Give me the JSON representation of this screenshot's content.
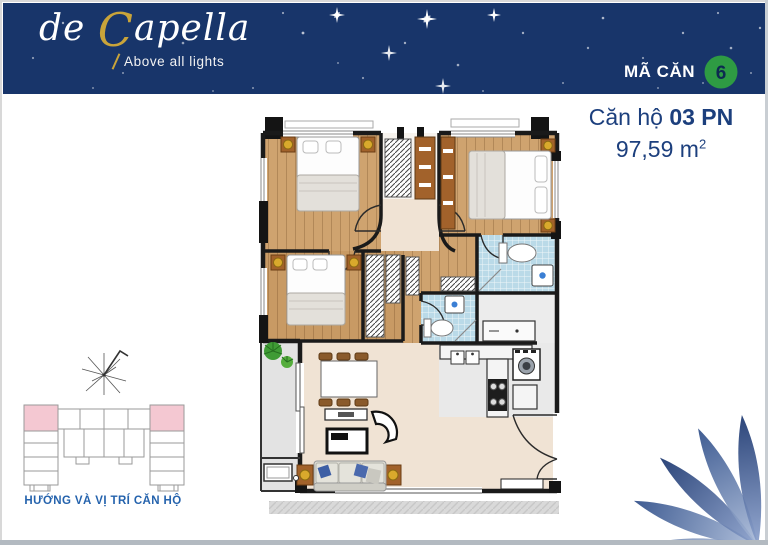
{
  "header": {
    "logo": {
      "part1": "de ",
      "part2": "C",
      "part3": "apella",
      "tagline": "Above all lights"
    },
    "unit_code": {
      "label": "MÃ CĂN",
      "value": "6"
    }
  },
  "unit_info": {
    "title_regular": "Căn hộ ",
    "title_bold": "03 PN",
    "area": "97,59 m",
    "area_sup": "2"
  },
  "key_plan": {
    "caption": "HƯỚNG VÀ VỊ TRÍ CĂN HỘ"
  },
  "floor_plan": {
    "rooms": [
      "bedroom-1",
      "bedroom-2-master",
      "bedroom-3",
      "hallway-t",
      "bathroom-master",
      "bathroom-2",
      "kitchen",
      "living-dining",
      "balcony",
      "entry",
      "walk-in-closet",
      "laundry"
    ],
    "furniture": [
      "double-bed",
      "double-bed",
      "double-bed",
      "nightstand-lamps",
      "wardrobe-hatch",
      "dining-table-6-chairs",
      "tv-console",
      "coffee-table",
      "armchair",
      "sofa-blue-pillows",
      "side-tables",
      "plants",
      "ac-unit",
      "kitchen-counter-double-sink",
      "stove-4-burner",
      "washing-machine",
      "toilet",
      "toilet",
      "vanity-sink",
      "vanity-sink",
      "entry-double-door"
    ]
  },
  "colors": {
    "header_bg": "#18356a",
    "logo_gold": "#c9a43a",
    "badge_green": "#2e9b43",
    "badge_text": "#0d2a50",
    "title_blue": "#1c3f7d",
    "caption_blue": "#2563ad",
    "wall": "#1a1a1a",
    "wood": "#cfa36f",
    "cream": "#f0e3d4",
    "tile": "#badae8",
    "kitchen_gray": "#e9e9e9",
    "balcony_gray": "#e3e3e3",
    "cabinet_brown": "#a2622b",
    "sofa_gray": "#dcdbd3",
    "pillow_blue": "#3d5fa5",
    "plant_green": "#3f9b35",
    "key_pink": "#f4c8d2",
    "key_line": "#9a9a9a",
    "petal_dark": "#15316b",
    "petal_light": "#b6c3de"
  }
}
